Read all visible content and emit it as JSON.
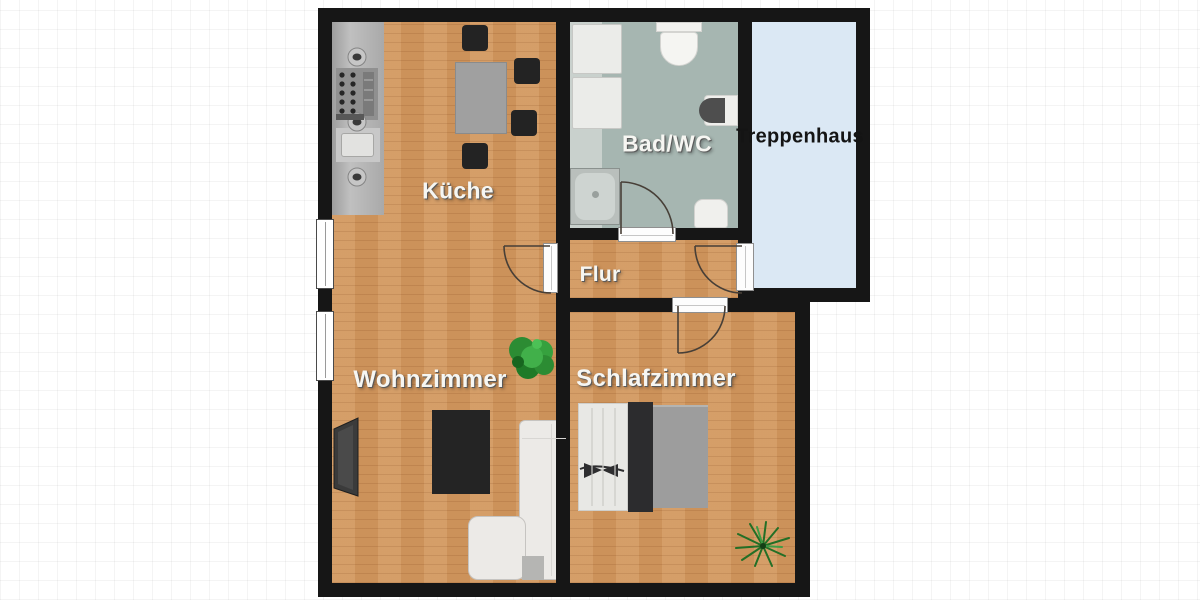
{
  "page": {
    "background": "#ffffff",
    "grid_color": "#ececec"
  },
  "floorplan": {
    "type": "apartment-floor-plan",
    "wall_color": "#161616",
    "floor_colors": {
      "wood": "#d2985f",
      "bathroom": "#a6b6b1",
      "staircase": "#dbe8f4"
    },
    "label_colors": {
      "light": "#f6f6f2",
      "dark": "#141414"
    },
    "rooms": [
      {
        "id": "kueche",
        "label": "Küche"
      },
      {
        "id": "bad-wc",
        "label": "Bad/WC"
      },
      {
        "id": "treppenhaus",
        "label": "Treppenhaus"
      },
      {
        "id": "flur",
        "label": "Flur"
      },
      {
        "id": "wohnzimmer",
        "label": "Wohnzimmer"
      },
      {
        "id": "schlafzimmer",
        "label": "Schlafzimmer"
      }
    ],
    "furniture": {
      "kueche": [
        "kitchen-counter",
        "stove-knobs",
        "burner",
        "kitchen-sink",
        "dining-table",
        "chairs-x4"
      ],
      "bad-wc": [
        "washer",
        "dryer",
        "toilet",
        "wall-sink",
        "shower",
        "hand-basin"
      ],
      "wohnzimmer": [
        "tv",
        "coffee-table",
        "corner-sofa",
        "plant"
      ],
      "schlafzimmer": [
        "double-bed",
        "plant"
      ]
    },
    "doors": [
      "bad-wc-door",
      "flur-living-door",
      "flur-treppenhaus-door",
      "schlafzimmer-door"
    ],
    "windows": [
      "left-wall-window-upper",
      "left-wall-window-lower"
    ]
  }
}
